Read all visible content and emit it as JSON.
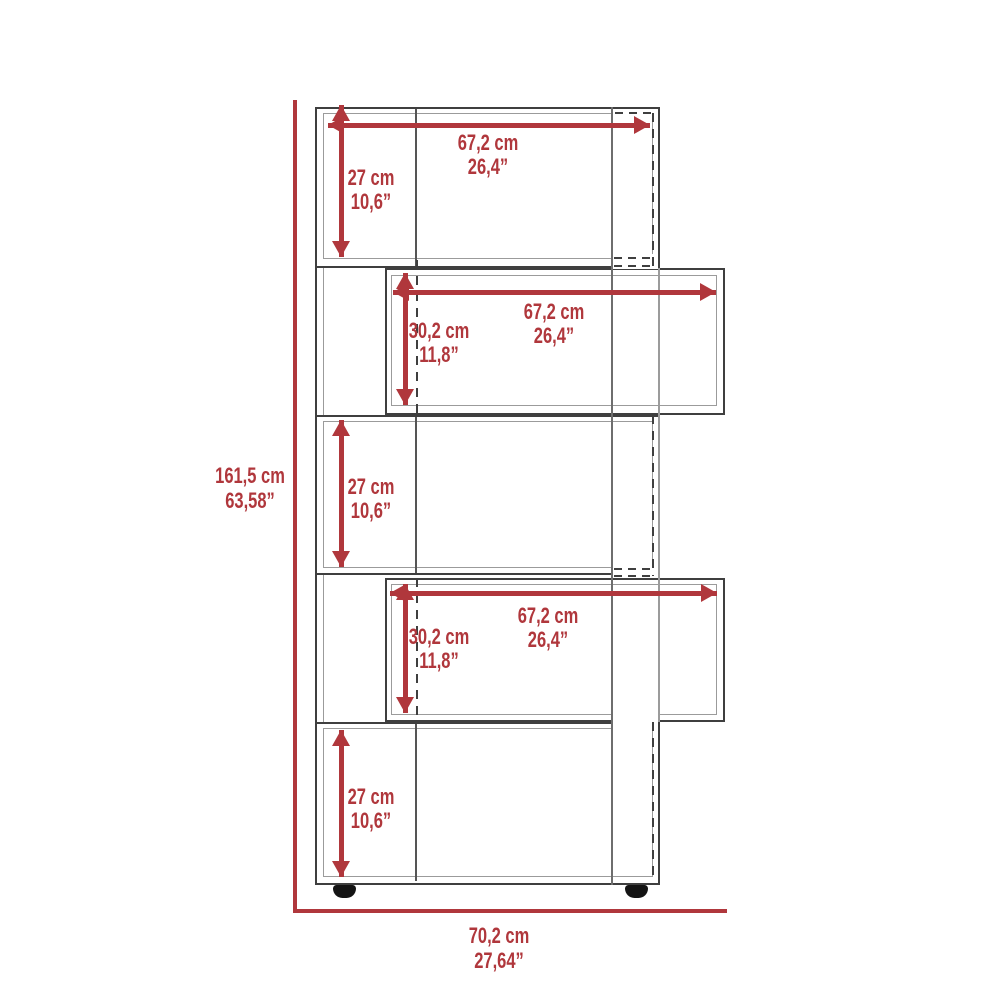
{
  "diagram": {
    "kind": "furniture-dimension-drawing",
    "shelf_count": 5
  },
  "colors": {
    "dimension_red": "#b0373c",
    "line_dark": "#3f3f3f",
    "line_mid": "#6e6e6e",
    "line_light": "#9b9b9b",
    "foot_black": "#141414",
    "background": "#ffffff"
  },
  "dimensions": {
    "overall_height": {
      "cm": "161,5 cm",
      "in": "63,58”"
    },
    "overall_width": {
      "cm": "70,2 cm",
      "in": "27,64”"
    },
    "shelf1": {
      "width_cm": "67,2 cm",
      "width_in": "26,4”",
      "height_cm": "27 cm",
      "height_in": "10,6”"
    },
    "shelf2": {
      "width_cm": "67,2 cm",
      "width_in": "26,4”",
      "height_cm": "30,2 cm",
      "height_in": "11,8”"
    },
    "shelf3": {
      "height_cm": "27 cm",
      "height_in": "10,6”"
    },
    "shelf4": {
      "width_cm": "67,2 cm",
      "width_in": "26,4”",
      "height_cm": "30,2 cm",
      "height_in": "11,8”"
    },
    "shelf5": {
      "height_cm": "27 cm",
      "height_in": "10,6”"
    }
  }
}
